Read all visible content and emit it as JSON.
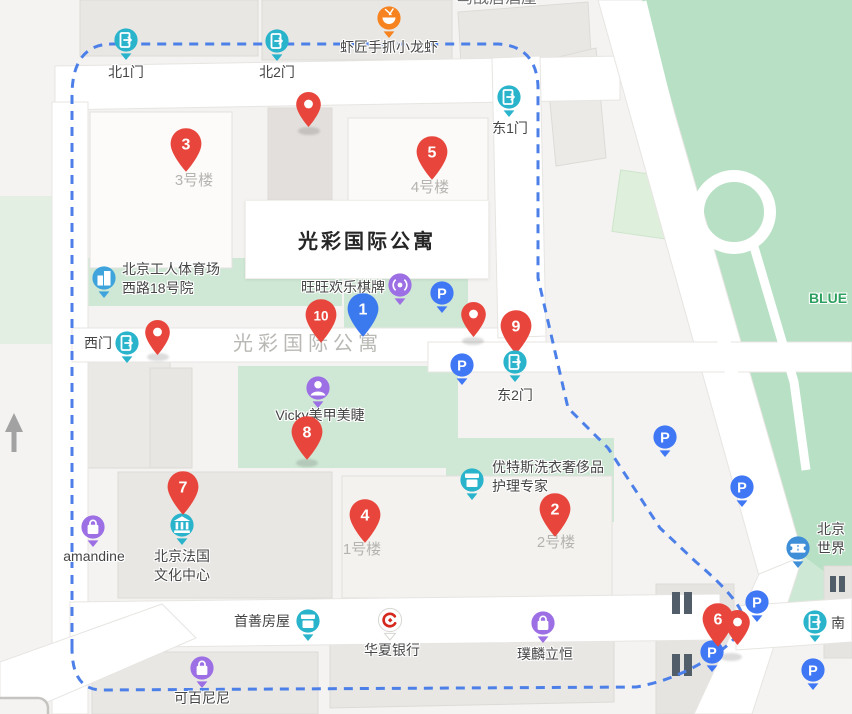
{
  "map": {
    "width": 852,
    "height": 714,
    "colors": {
      "marker_red": "#e8463c",
      "marker_blue": "#3b79ef",
      "boundary_blue": "#4c80e8",
      "gate_teal": "#2ab4cc",
      "poi_purple": "#9c6fe4",
      "poi_orange": "#f6831f",
      "poi_blue": "#3fa4dc",
      "parking_blue": "#3f77f5",
      "park_green": "#b7e0c4",
      "bank_logo_red": "#d5281e",
      "label_grey": "#b5b3af"
    },
    "info_box": {
      "label": "光彩国际公寓"
    }
  },
  "region_labels": [
    {
      "id": "residence-map-label",
      "text": "光彩国际公寓",
      "x": 308,
      "y": 335,
      "cls": "big-grey",
      "align": "center"
    },
    {
      "id": "park-label",
      "text": "BLUE",
      "x": 828,
      "y": 289,
      "cls": "green",
      "align": "center"
    },
    {
      "id": "top-partial-label",
      "text": "鸟战居酒屋",
      "x": 497,
      "y": -11,
      "cls": "grey-md",
      "align": "center"
    }
  ],
  "building_labels": [
    {
      "text": "3号楼",
      "x": 194,
      "y": 171
    },
    {
      "text": "4号楼",
      "x": 430,
      "y": 178
    },
    {
      "text": "1号楼",
      "x": 362,
      "y": 540
    },
    {
      "text": "2号楼",
      "x": 556,
      "y": 533
    }
  ],
  "markers": [
    {
      "n": "1",
      "x": 363,
      "y": 337,
      "color": "#3b79ef"
    },
    {
      "n": "2",
      "x": 555,
      "y": 537,
      "color": "#e8463c"
    },
    {
      "n": "3",
      "x": 186,
      "y": 172,
      "color": "#e8463c"
    },
    {
      "n": "4",
      "x": 365,
      "y": 543,
      "color": "#e8463c"
    },
    {
      "n": "5",
      "x": 432,
      "y": 180,
      "color": "#e8463c"
    },
    {
      "n": "6",
      "x": 718,
      "y": 647,
      "color": "#e8463c"
    },
    {
      "n": "7",
      "x": 183,
      "y": 515,
      "color": "#e8463c"
    },
    {
      "n": "8",
      "x": 307,
      "y": 460,
      "color": "#e8463c"
    },
    {
      "n": "9",
      "x": 516,
      "y": 354,
      "color": "#e8463c"
    },
    {
      "n": "10",
      "x": 321,
      "y": 343,
      "color": "#e8463c"
    }
  ],
  "plain_pins": [
    {
      "x": 308,
      "y": 127
    },
    {
      "x": 157,
      "y": 355
    },
    {
      "x": 473,
      "y": 337
    },
    {
      "x": 737,
      "y": 645
    }
  ],
  "pin_shadows": [
    {
      "x": 309,
      "y": 131
    },
    {
      "x": 158,
      "y": 357
    },
    {
      "x": 473,
      "y": 341
    },
    {
      "x": 307,
      "y": 463
    },
    {
      "x": 731,
      "y": 657
    }
  ],
  "parking": [
    {
      "x": 442,
      "y": 293
    },
    {
      "x": 462,
      "y": 365
    },
    {
      "x": 665,
      "y": 437
    },
    {
      "x": 742,
      "y": 487
    },
    {
      "x": 757,
      "y": 602
    },
    {
      "x": 813,
      "y": 670
    },
    {
      "x": 712,
      "y": 652,
      "z": 31
    }
  ],
  "poi_colors": {
    "gate": "#2ab4cc",
    "food": "#f6831f",
    "building": "#3fa4dc",
    "antenna": "#9c6fe4",
    "person": "#9c6fe4",
    "shop": "#2ab4cc",
    "museum": "#2ab4cc",
    "bag": "#9c6fe4",
    "bank": "#ffffff",
    "ticket": "#3f8fd8"
  },
  "pois": [
    {
      "id": "north-gate-1",
      "type": "gate",
      "name": "北1门",
      "x": 126,
      "y": 40,
      "label": {
        "x": 126,
        "y": 63,
        "align": "center"
      }
    },
    {
      "id": "north-gate-2",
      "type": "gate",
      "name": "北2门",
      "x": 277,
      "y": 41,
      "label": {
        "x": 277,
        "y": 63,
        "align": "center"
      }
    },
    {
      "id": "east-gate-1",
      "type": "gate",
      "name": "东1门",
      "x": 509,
      "y": 97,
      "label": {
        "x": 510,
        "y": 119,
        "align": "center"
      }
    },
    {
      "id": "west-gate",
      "type": "gate",
      "name": "西门",
      "x": 127,
      "y": 343,
      "label": {
        "x": 112,
        "y": 334,
        "align": "right"
      }
    },
    {
      "id": "east-gate-2",
      "type": "gate",
      "name": "东2门",
      "x": 515,
      "y": 362,
      "z": 36,
      "label": {
        "x": 515,
        "y": 386,
        "align": "center"
      }
    },
    {
      "id": "south-gate",
      "type": "gate",
      "name": "南",
      "x": 815,
      "y": 622,
      "label": {
        "x": 831,
        "y": 614,
        "align": "left"
      }
    },
    {
      "id": "crayfish-restaurant",
      "type": "food",
      "name": "虾匠手抓小龙虾",
      "x": 389,
      "y": 18,
      "label": {
        "x": 389,
        "y": 38,
        "align": "center"
      }
    },
    {
      "id": "workers-stadium-compound",
      "type": "building",
      "name": "北京工人体育场西路18号院",
      "lines": [
        "北京工人体育场",
        "西路18号院"
      ],
      "x": 104,
      "y": 278,
      "label": {
        "x": 122,
        "y": 260,
        "align": "left"
      }
    },
    {
      "id": "wangwang-chess",
      "type": "antenna",
      "name": "旺旺欢乐棋牌",
      "x": 400,
      "y": 285,
      "label": {
        "x": 385,
        "y": 278,
        "align": "right"
      }
    },
    {
      "id": "vicky-nails",
      "type": "person",
      "name": "Vicky美甲美睫",
      "x": 318,
      "y": 388,
      "label": {
        "x": 320,
        "y": 406,
        "align": "center"
      }
    },
    {
      "id": "laundry-expert",
      "type": "shop",
      "name": "优特斯洗衣奢侈品护理专家",
      "lines": [
        "优特斯洗衣奢侈品",
        "护理专家"
      ],
      "x": 472,
      "y": 480,
      "label": {
        "x": 492,
        "y": 458,
        "align": "left"
      }
    },
    {
      "id": "french-culture-center",
      "type": "museum",
      "name": "北京法国文化中心",
      "lines": [
        "北京法国",
        "文化中心"
      ],
      "x": 182,
      "y": 525,
      "label": {
        "x": 182,
        "y": 547,
        "align": "center"
      }
    },
    {
      "id": "amandine",
      "type": "bag",
      "name": "amandine",
      "x": 93,
      "y": 527,
      "label": {
        "x": 94,
        "y": 547,
        "align": "center"
      }
    },
    {
      "id": "shoushan-housing",
      "type": "shop",
      "name": "首善房屋",
      "x": 308,
      "y": 621,
      "label": {
        "x": 290,
        "y": 612,
        "align": "right"
      }
    },
    {
      "id": "huaxia-bank",
      "type": "bank",
      "name": "华夏银行",
      "x": 390,
      "y": 620,
      "label": {
        "x": 392,
        "y": 641,
        "align": "center"
      }
    },
    {
      "id": "pulinliheng",
      "type": "bag",
      "name": "璞麟立恒",
      "x": 543,
      "y": 623,
      "label": {
        "x": 545,
        "y": 645,
        "align": "center"
      }
    },
    {
      "id": "kebainini",
      "type": "bag",
      "name": "可百尼尼",
      "x": 202,
      "y": 668,
      "label": {
        "x": 202,
        "y": 689,
        "align": "center"
      }
    },
    {
      "id": "beijing-world",
      "type": "ticket",
      "name": "北京世界",
      "lines": [
        "北京",
        "世界"
      ],
      "x": 798,
      "y": 548,
      "label": {
        "x": 817,
        "y": 520,
        "align": "left"
      }
    }
  ]
}
